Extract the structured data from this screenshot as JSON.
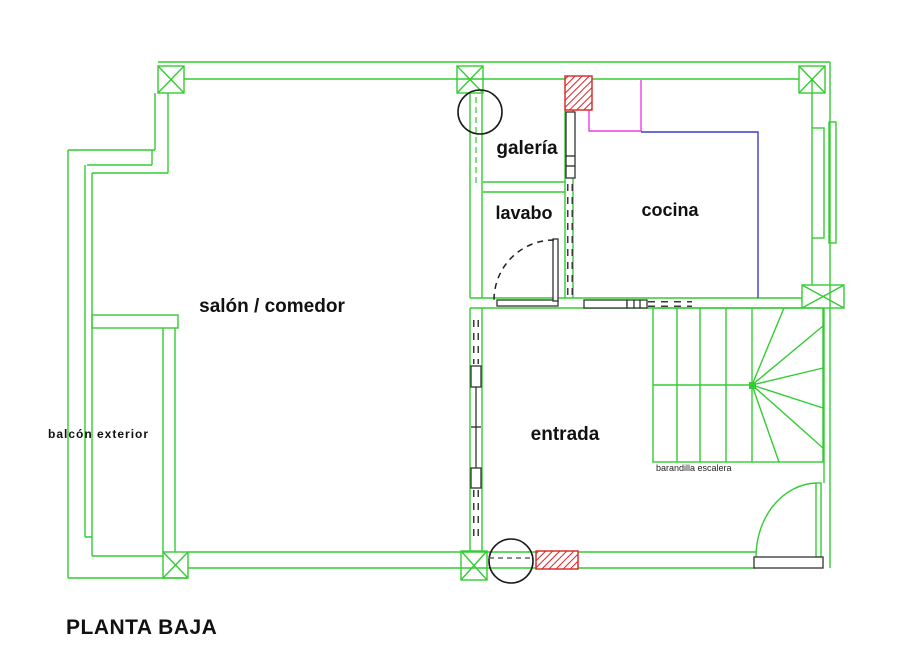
{
  "drawing": {
    "title": "PLANTA BAJA",
    "labels": {
      "living": "salón / comedor",
      "gallery": "galería",
      "toilet": "lavabo",
      "kitchen": "cocina",
      "entrance": "entrada",
      "balcony": "balcón exterior",
      "stair_note": "barandilla escalera"
    },
    "colors": {
      "wall": "#33cc33",
      "detail": "#1a1a1a",
      "hatch": "#dd2222",
      "magenta": "#ee3cee",
      "blue": "#3c3ccc",
      "background": "#ffffff"
    }
  }
}
